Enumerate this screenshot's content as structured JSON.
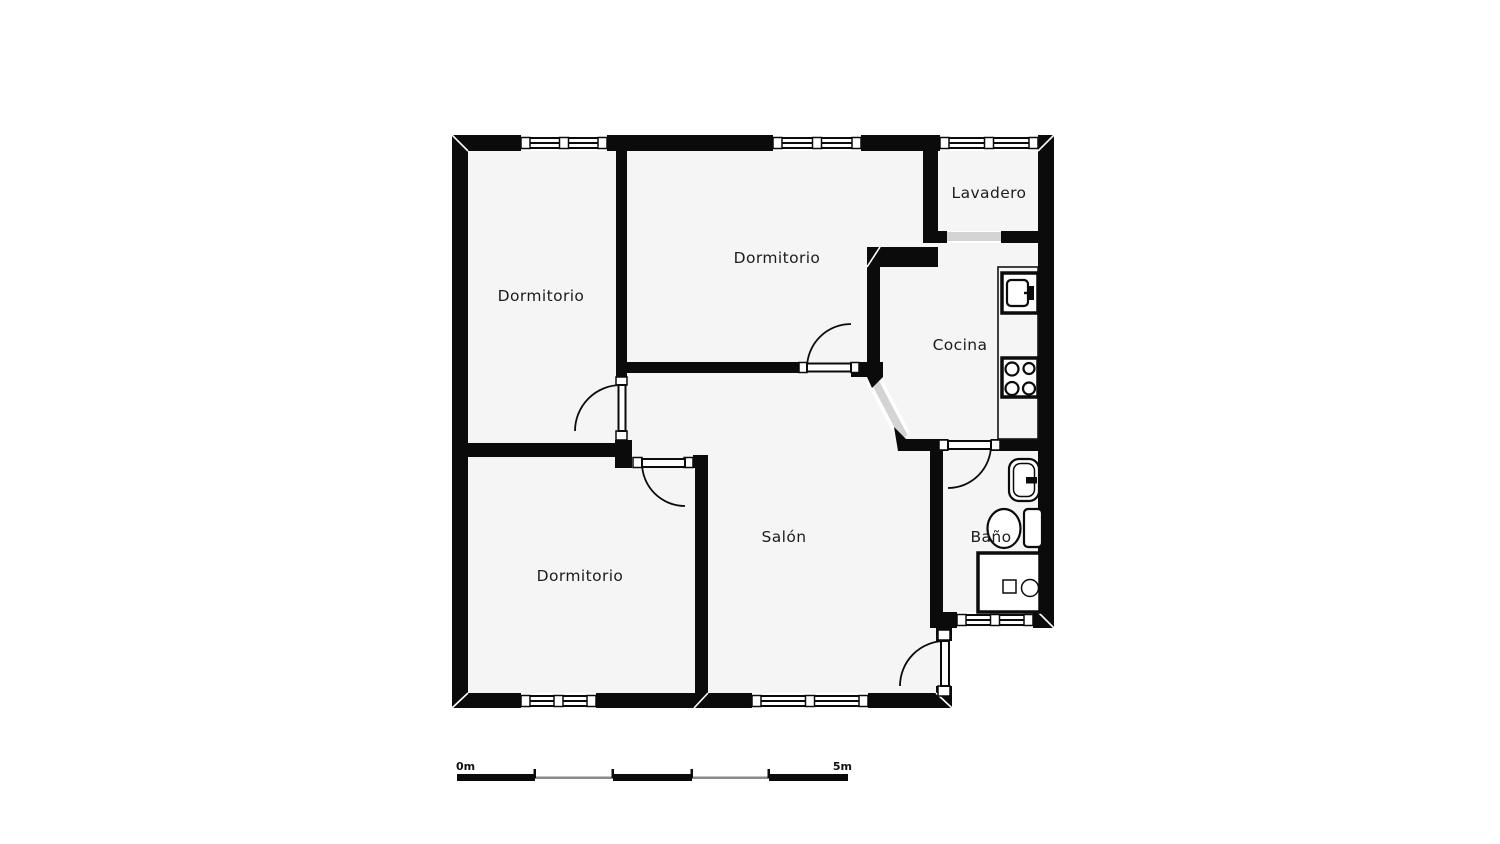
{
  "floorplan": {
    "title": "apartment-floor-plan",
    "rooms": [
      {
        "id": "dormitorio-1",
        "label": "Dormitorio"
      },
      {
        "id": "dormitorio-2",
        "label": "Dormitorio"
      },
      {
        "id": "lavadero",
        "label": "Lavadero"
      },
      {
        "id": "cocina",
        "label": "Cocina"
      },
      {
        "id": "dormitorio-3",
        "label": "Dormitorio"
      },
      {
        "id": "salon",
        "label": "Salón"
      },
      {
        "id": "bano",
        "label": "Baño"
      }
    ],
    "doors": [
      "dormitorio-1-door",
      "dormitorio-2-door",
      "dormitorio-3-door",
      "bano-door",
      "entrance-door"
    ],
    "openings": [
      "lavadero-cocina-opening",
      "cocina-salon-diagonal-opening"
    ],
    "window_count": 6,
    "fixtures": [
      "kitchen-counter",
      "kitchen-sink-icon",
      "stove-icon",
      "washbasin-icon",
      "toilet-icon",
      "shower-icon"
    ],
    "colors": {
      "wall": "#0b0b0b",
      "floor": "#f5f5f5",
      "background": "#ffffff",
      "opening_gray": "#d4d4d4",
      "text": "#1c1c1c",
      "scale_gray": "#8a8a8a"
    },
    "scale_bar": {
      "start_label": "0m",
      "end_label": "5m",
      "length_meters": 5,
      "segments": 5
    }
  }
}
